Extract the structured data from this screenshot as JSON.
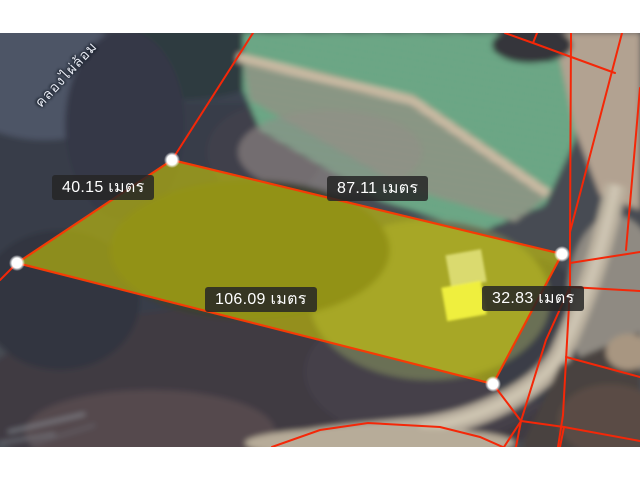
{
  "map": {
    "type": "satellite-cadastral-overlay",
    "road_watermark": "คลองไผ่ล้อม",
    "parcel": {
      "highlight_fill": "#d8d600",
      "boundary_color": "#f43708",
      "label_background": "#262626",
      "label_text_color": "#ffffff",
      "measurements": [
        {
          "side": "north-west",
          "text": "40.15 เมตร"
        },
        {
          "side": "north-east",
          "text": "87.11 เมตร"
        },
        {
          "side": "south",
          "text": "106.09 เมตร"
        },
        {
          "side": "east",
          "text": "32.83 เมตร"
        }
      ]
    }
  }
}
